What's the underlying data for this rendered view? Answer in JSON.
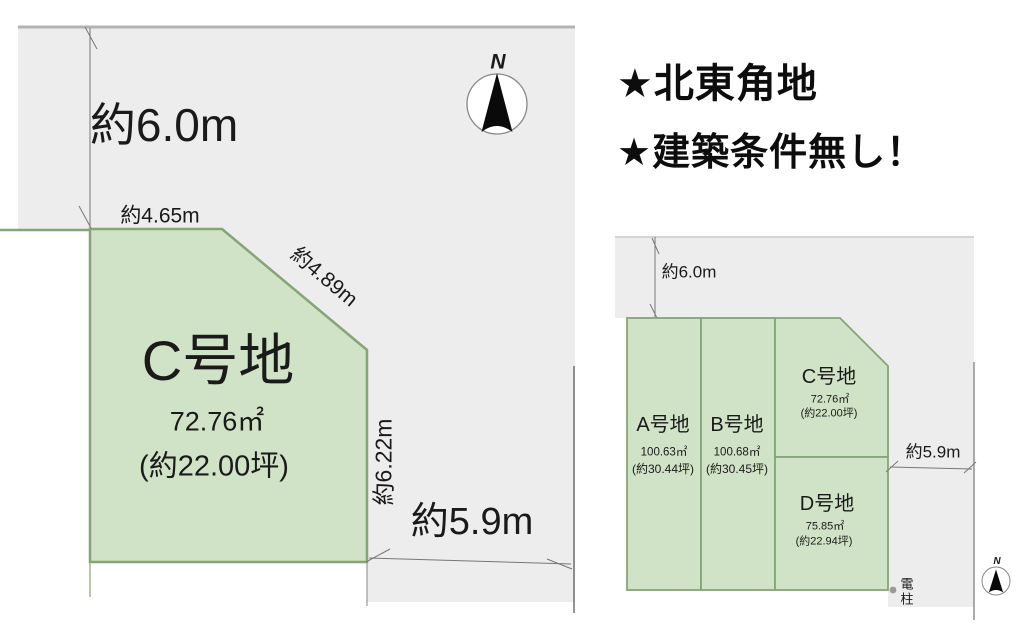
{
  "headlines": {
    "line1": "★北東角地",
    "line2": "★建築条件無し！"
  },
  "main_diagram": {
    "road_width_top": "約6.0m",
    "edge_top": "約4.65m",
    "edge_diagonal": "約4.89m",
    "edge_right": "約6.22m",
    "road_width_right": "約5.9m",
    "plot": {
      "name": "C号地",
      "area_sqm": "72.76㎡",
      "area_tsubo": "(約22.00坪)"
    },
    "compass_label": "N"
  },
  "overview_diagram": {
    "road_width_top": "約6.0m",
    "road_width_right": "約5.9m",
    "utility_pole_label": "電柱",
    "compass_label": "N",
    "plots": [
      {
        "name": "A号地",
        "area_sqm": "100.63㎡",
        "area_tsubo": "(約30.44坪)"
      },
      {
        "name": "B号地",
        "area_sqm": "100.68㎡",
        "area_tsubo": "(約30.45坪)"
      },
      {
        "name": "C号地",
        "area_sqm": "72.76㎡",
        "area_tsubo": "(約22.00坪)"
      },
      {
        "name": "D号地",
        "area_sqm": "75.85㎡",
        "area_tsubo": "(約22.94坪)"
      }
    ]
  },
  "colors": {
    "plot_fill": "#d1e3c6",
    "plot_border": "#86a478",
    "road_fill": "#ededed",
    "road_top_border": "#b3b3b3",
    "dimension_line": "#777777",
    "text": "#1a1a1a"
  }
}
